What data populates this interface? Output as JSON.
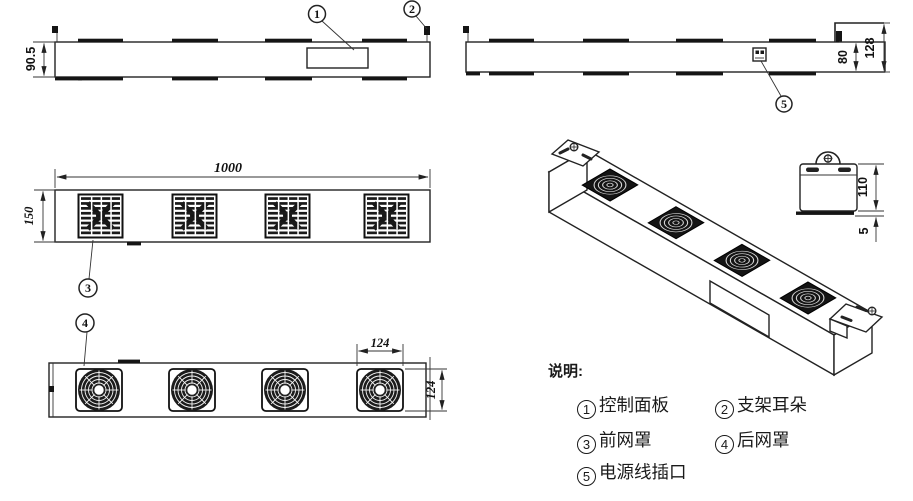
{
  "drawing": {
    "legend": {
      "title": "说明:",
      "items": [
        {
          "num": "1",
          "label": "控制面板"
        },
        {
          "num": "2",
          "label": "支架耳朵"
        },
        {
          "num": "3",
          "label": "前网罩"
        },
        {
          "num": "4",
          "label": "后网罩"
        },
        {
          "num": "5",
          "label": "电源线插口"
        }
      ]
    },
    "dimensions": {
      "front_height": "90.5",
      "rear_height": "80",
      "rear_total_height": "128",
      "overall_length": "1000",
      "body_width": "150",
      "fan_width": "124",
      "fan_height": "124",
      "end_cap_height": "110",
      "flange_thickness": "5"
    },
    "callouts": {
      "c1": "1",
      "c2": "2",
      "c3": "3",
      "c4": "4",
      "c5": "5"
    },
    "colors": {
      "line": "#222222",
      "fill_dark": "#161616",
      "background": "#ffffff"
    }
  }
}
